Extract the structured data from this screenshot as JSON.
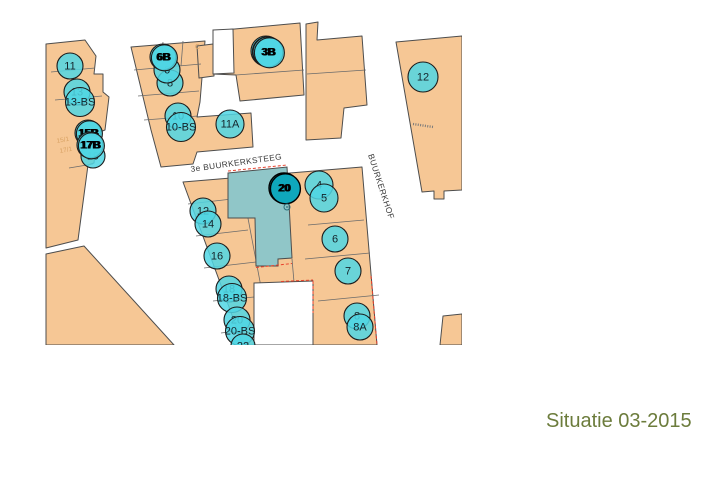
{
  "title": {
    "text": "Situatie 03-2015"
  },
  "colors": {
    "building": "#f6c795",
    "buildingStroke": "#4d4d4d",
    "circle": "#50d6e4",
    "circleDark": "#0fa8bc",
    "highlight": "#90c6c8",
    "redDash": "#e8412c",
    "title": "#6c7c3c",
    "parcelText": "#d8a263",
    "streetText": "#3a3a3a"
  },
  "map": {
    "streets": [
      {
        "name": "3e BUURKERKSTEEG"
      },
      {
        "name": "BUURKERKHOF"
      }
    ],
    "parcel_texts": [
      {
        "text": "15/1"
      },
      {
        "text": "17/1"
      },
      {
        "text": "C"
      }
    ],
    "markers": [
      {
        "label": "11",
        "x": 25,
        "y": 56,
        "r": 13,
        "type": "normal"
      },
      {
        "label": "13",
        "x": 32,
        "y": 82,
        "r": 13,
        "type": "normal"
      },
      {
        "label": "13-BS",
        "x": 35,
        "y": 92,
        "r": 14.5,
        "type": "normal"
      },
      {
        "label": "19",
        "x": 48,
        "y": 146,
        "r": 12,
        "type": "normal"
      },
      {
        "label": "15B",
        "x": 43,
        "y": 123,
        "r": 13,
        "type": "smudge"
      },
      {
        "label": "17B",
        "x": 45,
        "y": 135,
        "r": 13,
        "type": "smudge"
      },
      {
        "label": "8",
        "x": 125,
        "y": 73,
        "r": 13,
        "type": "normal"
      },
      {
        "label": "6",
        "x": 122,
        "y": 60,
        "r": 13,
        "type": "normal"
      },
      {
        "label": "6B",
        "x": 118,
        "y": 47,
        "r": 13,
        "type": "smudge"
      },
      {
        "label": "10",
        "x": 133,
        "y": 106,
        "r": 13,
        "type": "normal"
      },
      {
        "label": "10-BS",
        "x": 136,
        "y": 117,
        "r": 14.5,
        "type": "normal"
      },
      {
        "label": "11A",
        "x": 185,
        "y": 114,
        "r": 14,
        "type": "normal"
      },
      {
        "label": "3A",
        "x": 221,
        "y": 41,
        "r": 15,
        "type": "smudge"
      },
      {
        "label": "3B",
        "x": 223,
        "y": 42,
        "r": 15,
        "type": "smudge"
      },
      {
        "label": "12",
        "x": 378,
        "y": 67,
        "r": 15,
        "type": "normal"
      },
      {
        "label": "12",
        "x": 158,
        "y": 201,
        "r": 13,
        "type": "normal"
      },
      {
        "label": "14",
        "x": 163,
        "y": 214,
        "r": 13,
        "type": "normal"
      },
      {
        "label": "16",
        "x": 172,
        "y": 246,
        "r": 13,
        "type": "normal"
      },
      {
        "label": "18",
        "x": 184,
        "y": 279,
        "r": 13,
        "type": "normal"
      },
      {
        "label": "18-BS",
        "x": 187,
        "y": 288,
        "r": 14.5,
        "type": "normal"
      },
      {
        "label": "20",
        "x": 192,
        "y": 310,
        "r": 13,
        "type": "normal"
      },
      {
        "label": "20-BS",
        "x": 195,
        "y": 321,
        "r": 14.5,
        "type": "normal"
      },
      {
        "label": "22",
        "x": 198,
        "y": 336,
        "r": 12,
        "type": "normal"
      },
      {
        "label": "4",
        "x": 274,
        "y": 175,
        "r": 14,
        "type": "normal"
      },
      {
        "label": "5",
        "x": 279,
        "y": 188,
        "r": 14,
        "type": "normal"
      },
      {
        "label": "6",
        "x": 290,
        "y": 229,
        "r": 13,
        "type": "normal"
      },
      {
        "label": "7",
        "x": 303,
        "y": 261,
        "r": 13,
        "type": "normal"
      },
      {
        "label": "8",
        "x": 312,
        "y": 306,
        "r": 13,
        "type": "normal"
      },
      {
        "label": "8A",
        "x": 315,
        "y": 317,
        "r": 13,
        "type": "normal"
      },
      {
        "label": "20",
        "x": 239,
        "y": 178,
        "r": 15,
        "type": "dark"
      }
    ]
  }
}
